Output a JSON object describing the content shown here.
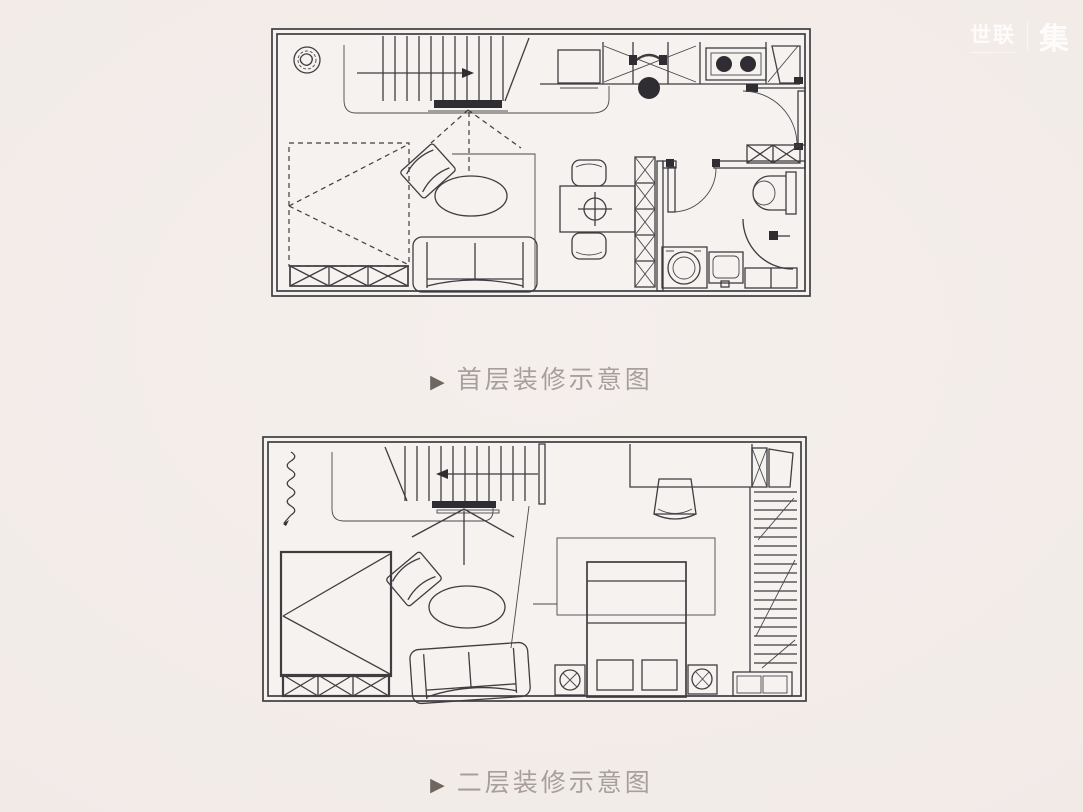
{
  "page": {
    "background": "#f2ebe8"
  },
  "watermark": {
    "brand": "世联",
    "suffix": "集"
  },
  "captions": {
    "first_floor": {
      "marker": "▶",
      "label": "首层装修示意图"
    },
    "second_floor": {
      "marker": "▶",
      "label": "二层装修示意图"
    }
  },
  "colors": {
    "line": "#3f3d40",
    "line_dark": "#2f2d32",
    "plan_fill": "#f5f2ef",
    "caption_text": "#a99f9a",
    "caption_marker": "#6e665f",
    "watermark": "rgba(255,255,255,0.82)"
  },
  "plans": {
    "first_floor": {
      "items": [
        "exterior-walls",
        "floor-drain-icon",
        "staircase-up",
        "stair-direction-arrow",
        "loft-edge-line",
        "projection-dashed-lines",
        "fold-down-bed",
        "bed-storage-cabinet",
        "armchair",
        "area-rug",
        "sofa",
        "kitchen-counter",
        "refrigerator",
        "desk-chair",
        "gas-stove",
        "corner-cabinet",
        "entry-door",
        "shoe-cabinet",
        "dining-table",
        "dining-chairs",
        "table-burner",
        "storage-column",
        "bathroom-door",
        "toilet",
        "shower-partition",
        "shower-head",
        "shower-bench",
        "washing-machine",
        "wash-basin"
      ]
    },
    "second_floor": {
      "items": [
        "exterior-walls",
        "coil-symbol",
        "staircase-down",
        "stair-direction-arrow",
        "loft-edge-line",
        "sight-lines",
        "single-bed",
        "bed-storage-cabinet",
        "armchair",
        "area-rug",
        "sofa",
        "desk",
        "desk-chair",
        "closet-x-cabinet",
        "closet-door-panel",
        "wardrobe-hanging-rail",
        "wardrobe-drawers",
        "bed-rug",
        "double-bed",
        "pillows",
        "nightstand-left",
        "nightstand-right"
      ]
    }
  }
}
